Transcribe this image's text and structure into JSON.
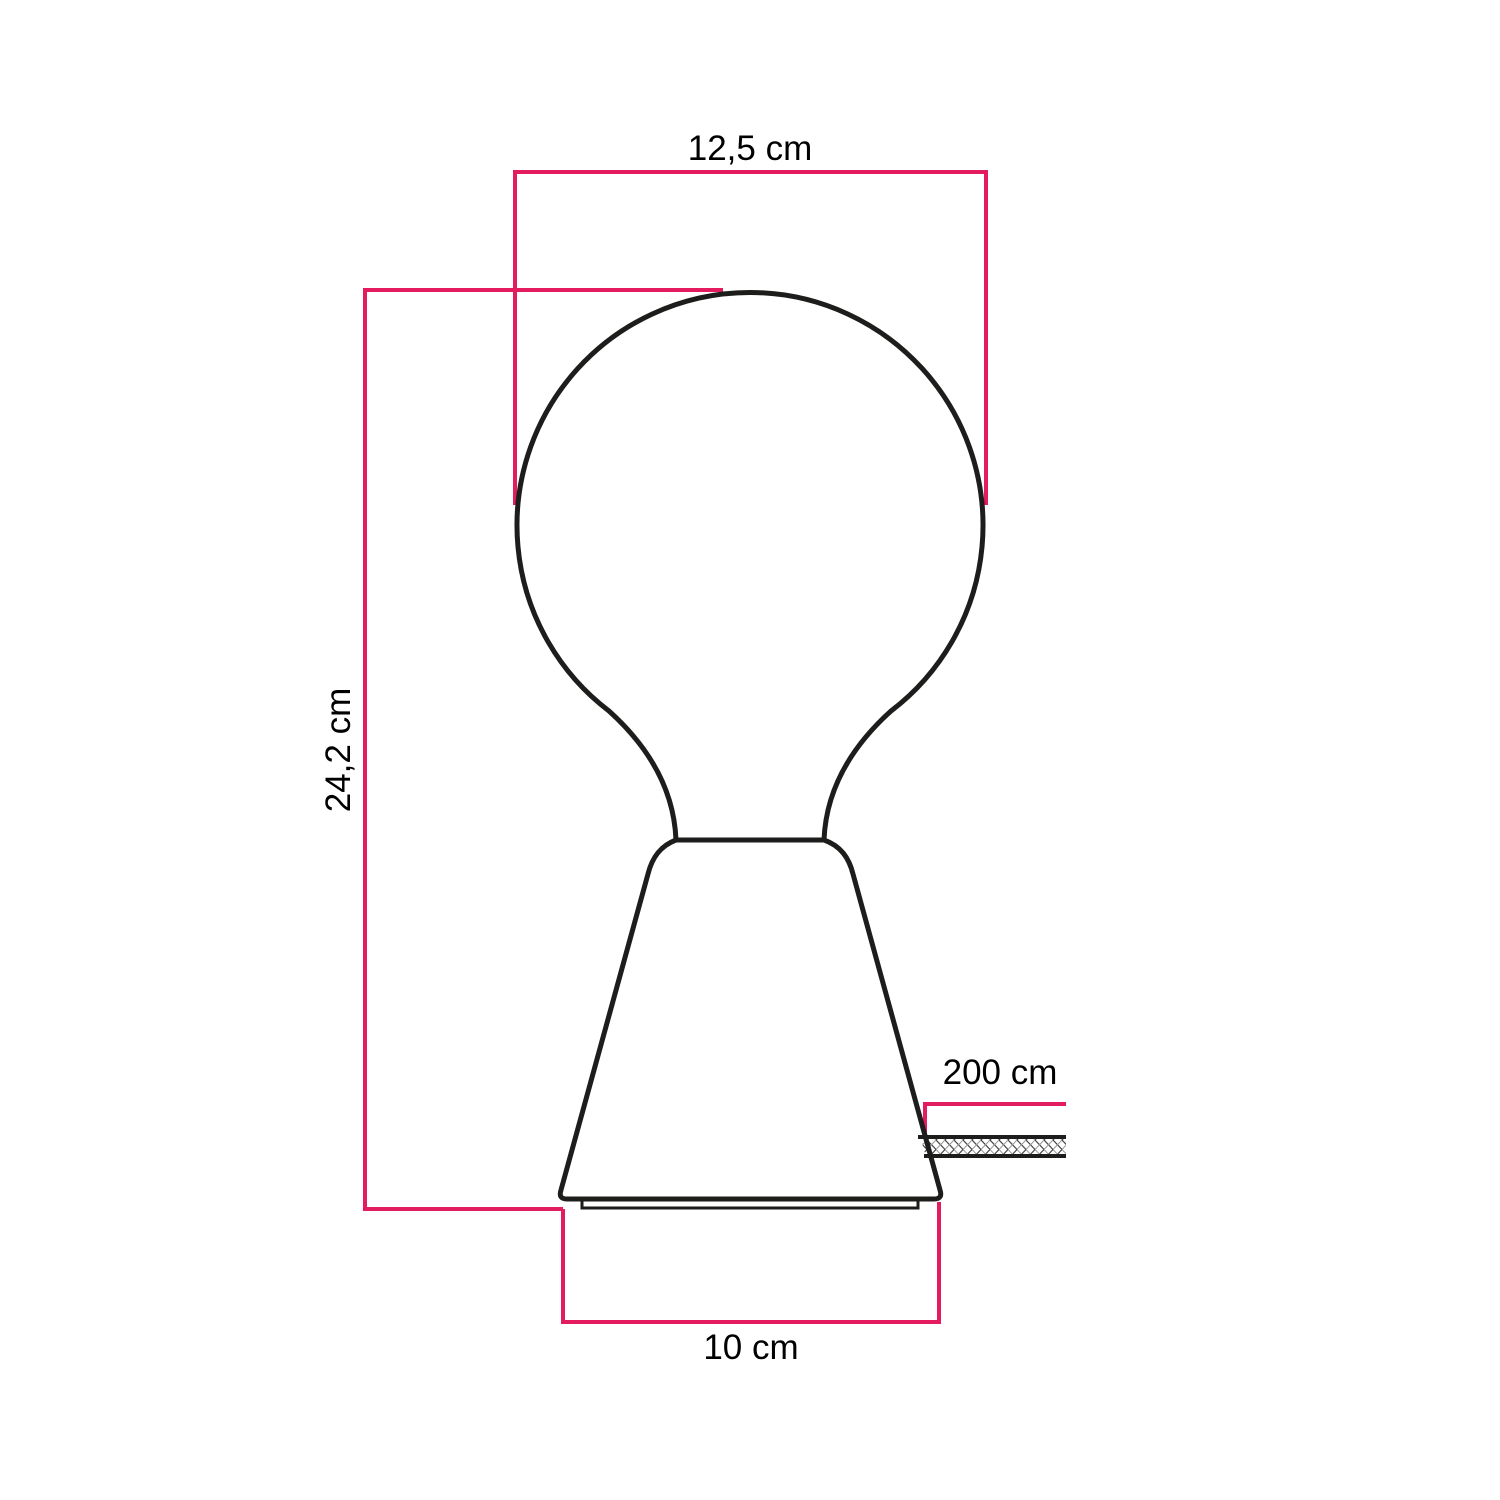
{
  "diagram": {
    "dimensions": {
      "bulb_width": {
        "label": "12,5 cm"
      },
      "total_height": {
        "label": "24,2 cm"
      },
      "cable_length": {
        "label": "200 cm"
      },
      "base_width": {
        "label": "10 cm"
      }
    },
    "colors": {
      "dimension_line": "#e31b5f",
      "outline": "#1d1d1b",
      "label_text": "#000000",
      "background": "#ffffff"
    }
  }
}
